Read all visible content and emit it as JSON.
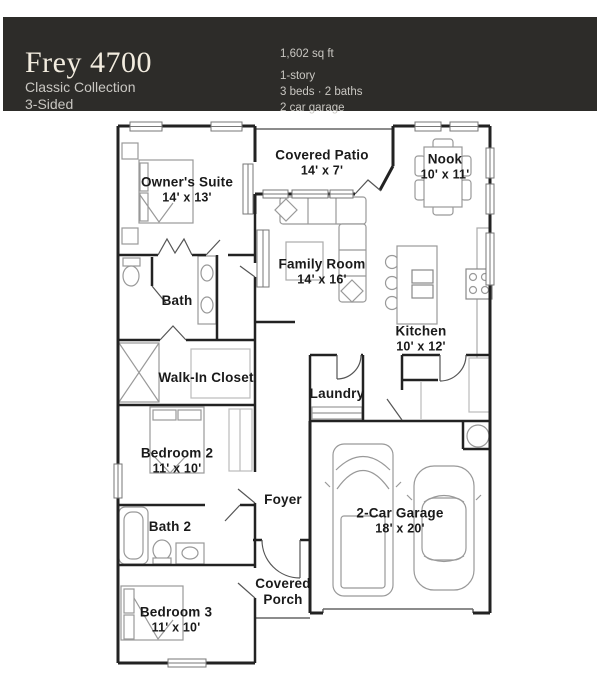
{
  "header": {
    "title": "Frey 4700",
    "collection": "Classic Collection",
    "elevation": "3-Sided",
    "specs": {
      "sqft": "1,602 sq ft",
      "stories": "1-story",
      "beds_baths": "3 beds · 2 baths",
      "garage": "2 car garage"
    }
  },
  "rooms": {
    "owners_suite": {
      "name": "Owner's Suite",
      "dims": "14' x 13'"
    },
    "covered_patio": {
      "name": "Covered Patio",
      "dims": "14' x 7'"
    },
    "nook": {
      "name": "Nook",
      "dims": "10' x 11'"
    },
    "family_room": {
      "name": "Family Room",
      "dims": "14' x 16'"
    },
    "bath": {
      "name": "Bath"
    },
    "kitchen": {
      "name": "Kitchen",
      "dims": "10' x 12'"
    },
    "walk_in_closet": {
      "name": "Walk-In Closet"
    },
    "laundry": {
      "name": "Laundry"
    },
    "bedroom_2": {
      "name": "Bedroom 2",
      "dims": "11' x 10'"
    },
    "foyer": {
      "name": "Foyer"
    },
    "bath_2": {
      "name": "Bath 2"
    },
    "garage": {
      "name": "2-Car Garage",
      "dims": "18' x 20'"
    },
    "covered_porch": {
      "name": "Covered Porch"
    },
    "bedroom_3": {
      "name": "Bedroom 3",
      "dims": "11' x 10'"
    }
  },
  "colors": {
    "header_bg": "#2d2c29",
    "header_title": "#f2ecdf",
    "header_text": "#c9c7c2",
    "wall": "#222222",
    "furniture": "#999999",
    "label": "#1a1a1a"
  }
}
